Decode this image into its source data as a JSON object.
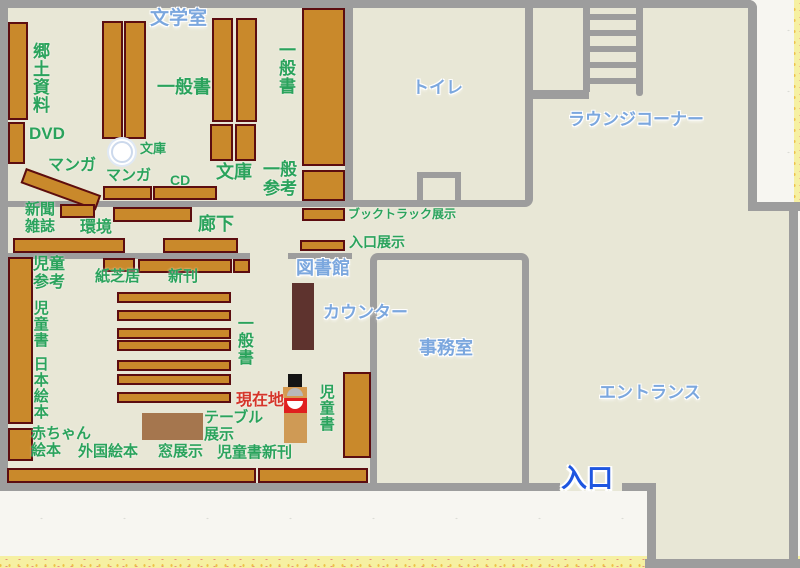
{
  "title": "library-floor-map",
  "rooms": {
    "literature_room": "文学室",
    "toilet": "トイレ",
    "lounge_corner": "ラウンジコーナー",
    "library": "図書館",
    "counter": "カウンター",
    "office": "事務室",
    "entrance_hall": "エントランス",
    "entry": "入口"
  },
  "sections": {
    "local_materials": "郷土資料",
    "dvd": "DVD",
    "manga_slanted": "マンガ",
    "general_books_lit": "一般書",
    "bunko_pillar": "文庫",
    "manga_row": "マンガ",
    "cd": "CD",
    "bunko_shelves": "文庫",
    "general_reference": "一般\n参考",
    "general_books_side": "一般書",
    "newspapers_magazines": "新聞\n雑誌",
    "environment": "環境",
    "corridor": "廊下",
    "booktruck_display": "ブックトラック展示",
    "entrance_display": "入口展示",
    "children_reference": "児童\n参考",
    "kamishibai": "紙芝居",
    "new_books": "新刊",
    "children_books_left": "児童書",
    "general_books_children": "一般書",
    "japanese_picture_books": "日本絵本",
    "baby_picture_books": "赤ちゃん\n絵本",
    "foreign_picture_books": "外国絵本",
    "window_display": "窓展示",
    "children_new_books": "児童書新刊",
    "table_display": "テーブル\n展示",
    "children_books_right": "児童書"
  },
  "marker": {
    "current_location": "現在地"
  },
  "colors": {
    "floor": "#e8e7d6",
    "wall": "#9d9d9d",
    "shelf_fill": "#c9892b",
    "shelf_outline": "#5c0d10",
    "counter_desk": "#5e332e",
    "display_table": "#a5764e",
    "kiosk_red": "#e01f1f",
    "room_label_blue": "#7ba7de",
    "entry_label_blue": "#1e56e0",
    "section_label_green": "#2aa35c",
    "current_location_red": "#d5352a",
    "paper_border_yellow": "#f6f0a2"
  }
}
